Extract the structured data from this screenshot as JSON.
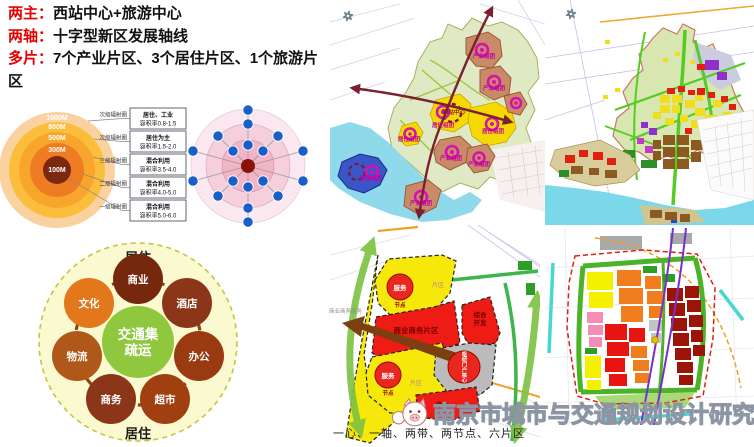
{
  "header": {
    "term_color": "#E60000",
    "items": [
      {
        "term": "两主：",
        "desc": "西站中心+旅游中心"
      },
      {
        "term": "两轴：",
        "desc": "十字型新区发展轴线"
      },
      {
        "term": "多片：",
        "desc": "7个产业片区、3个居住片区、1个旅游片区"
      }
    ]
  },
  "radial": {
    "rings": [
      {
        "label": "1000M",
        "color": "#FAD2A0"
      },
      {
        "label": "800M",
        "color": "#FBBE3C"
      },
      {
        "label": "500M",
        "color": "#F7A62B"
      },
      {
        "label": "300M",
        "color": "#EE7C22"
      },
      {
        "label": "100M",
        "color": "#7A2810"
      }
    ],
    "callouts": [
      "次级辐射圈",
      "次级辐射圈",
      "三级辐射圈",
      "二级辐射圈",
      "一级辐射圈"
    ],
    "boxes": [
      {
        "use": "居住、工业",
        "far": "容积率0.8-1.5"
      },
      {
        "use": "居住为主",
        "far": "容积率1.5-2.0"
      },
      {
        "use": "混合利用",
        "far": "容积率3.5-4.0"
      },
      {
        "use": "混合利用",
        "far": "容积率4.0-5.0"
      },
      {
        "use": "混合利用",
        "far": "容积率5.0-6.0"
      }
    ]
  },
  "node_diagram": {
    "center_color": "#8B1208",
    "node_color": "#1A5FC8"
  },
  "flow": {
    "top_label": "居住",
    "bottom_label": "居住",
    "center": {
      "line1": "交通集",
      "line2": "疏运",
      "color": "#8FC73E"
    },
    "nodes": [
      {
        "label": "商业",
        "color": "#76280E"
      },
      {
        "label": "酒店",
        "color": "#8B3618"
      },
      {
        "label": "办公",
        "color": "#9A3A10"
      },
      {
        "label": "超市",
        "color": "#A04010"
      },
      {
        "label": "商务",
        "color": "#8B3618"
      },
      {
        "label": "物流",
        "color": "#B0571A"
      },
      {
        "label": "文化",
        "color": "#E2771C"
      }
    ]
  },
  "map1": {
    "industry": "产业组团",
    "residential": "居住组团",
    "station": "西站中心",
    "tourism": "旅游组团"
  },
  "map3": {
    "left_note": "商业商务服务",
    "service": "服务",
    "node": "节点",
    "area": "片区",
    "business_zone": "商业商务片区",
    "comp1": "综合",
    "comp2": "开发",
    "hub": "枢纽门户核心",
    "comp_bottom": "综合",
    "caption": "一心、一轴、两带、两节点、六片区"
  },
  "watermark": {
    "text": "南京市城市与交通规划设计研究院"
  }
}
